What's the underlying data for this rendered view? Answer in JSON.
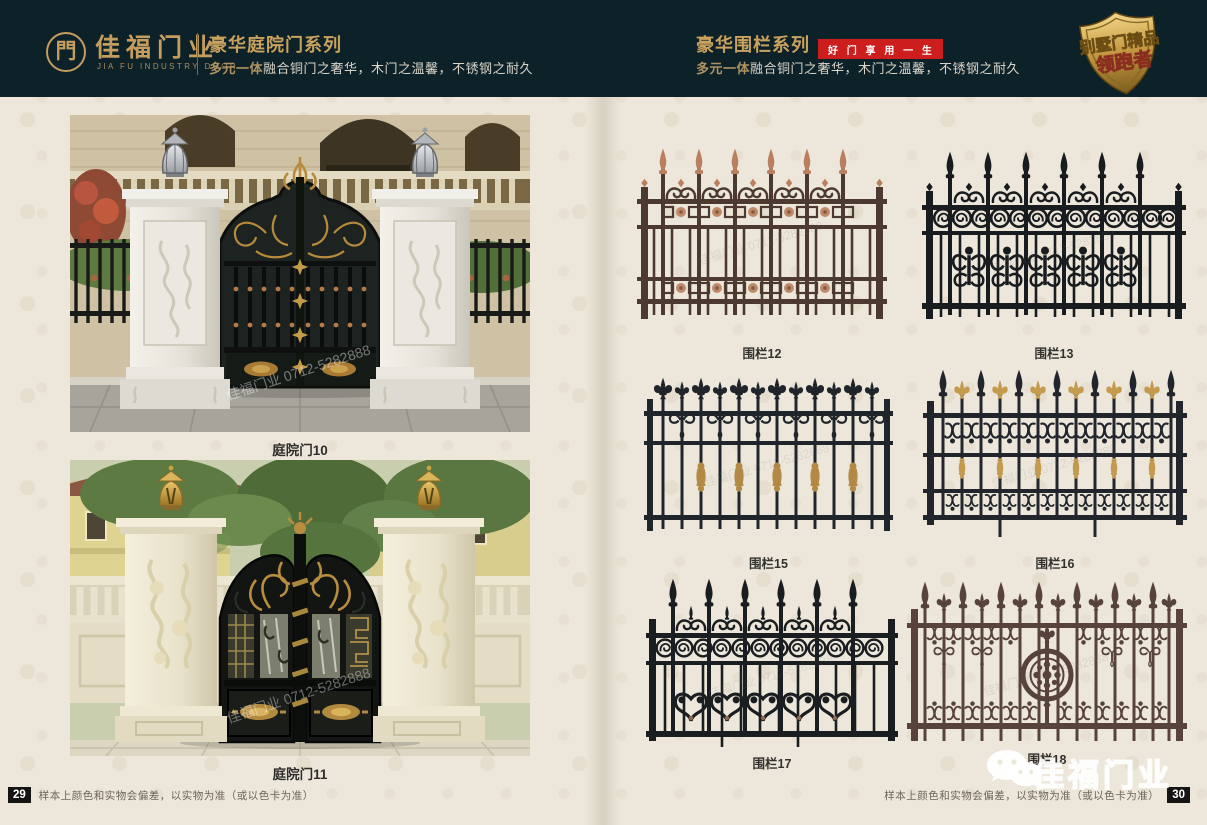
{
  "header": {
    "logo": {
      "glyph": "門",
      "brand": "佳福门业",
      "brand_en": "JIA FU INDUSTRY DOOR"
    },
    "left": {
      "title": "豪华庭院门系列",
      "subtitle_em": "多元一体",
      "subtitle": "融合铜门之奢华，木门之温馨，不锈钢之耐久"
    },
    "right": {
      "title": "豪华围栏系列",
      "slogan": "好 门 享 用 一 生",
      "subtitle_em": "多元一体",
      "subtitle": "融合铜门之奢华，木门之温馨，不锈钢之耐久"
    },
    "emblem": {
      "line1": "别墅门精品",
      "line2": "领跑者"
    }
  },
  "left_page": {
    "photos": [
      {
        "label": "庭院门10",
        "watermark": "佳福门业 0712-5282888"
      },
      {
        "label": "庭院门11",
        "watermark": "佳福门业 0712-5282888"
      }
    ],
    "page_number": "29",
    "disclaimer": "样本上颜色和实物会偏差，以实物为准（或以色卡为准）"
  },
  "right_page": {
    "fences": [
      {
        "label": "围栏12"
      },
      {
        "label": "围栏13"
      },
      {
        "label": "围栏15"
      },
      {
        "label": "围栏16"
      },
      {
        "label": "围栏17"
      },
      {
        "label": "围栏18"
      }
    ],
    "fence_watermark": "佳福门业 0712-5282888",
    "watermark_brand": "佳福门业",
    "page_number": "30",
    "disclaimer": "样本上颜色和实物会偏差，以实物为准（或以色卡为准）"
  },
  "colors": {
    "header_bg": "#0d2129",
    "gold": "#c59e5f",
    "red_badge": "#cd1e1e",
    "paper": "#ece7da",
    "fence_black": "#1d2126",
    "fence_bronze": "#4c3a31",
    "accent_copper": "#b97f5e",
    "accent_gold": "#c49a4e"
  }
}
